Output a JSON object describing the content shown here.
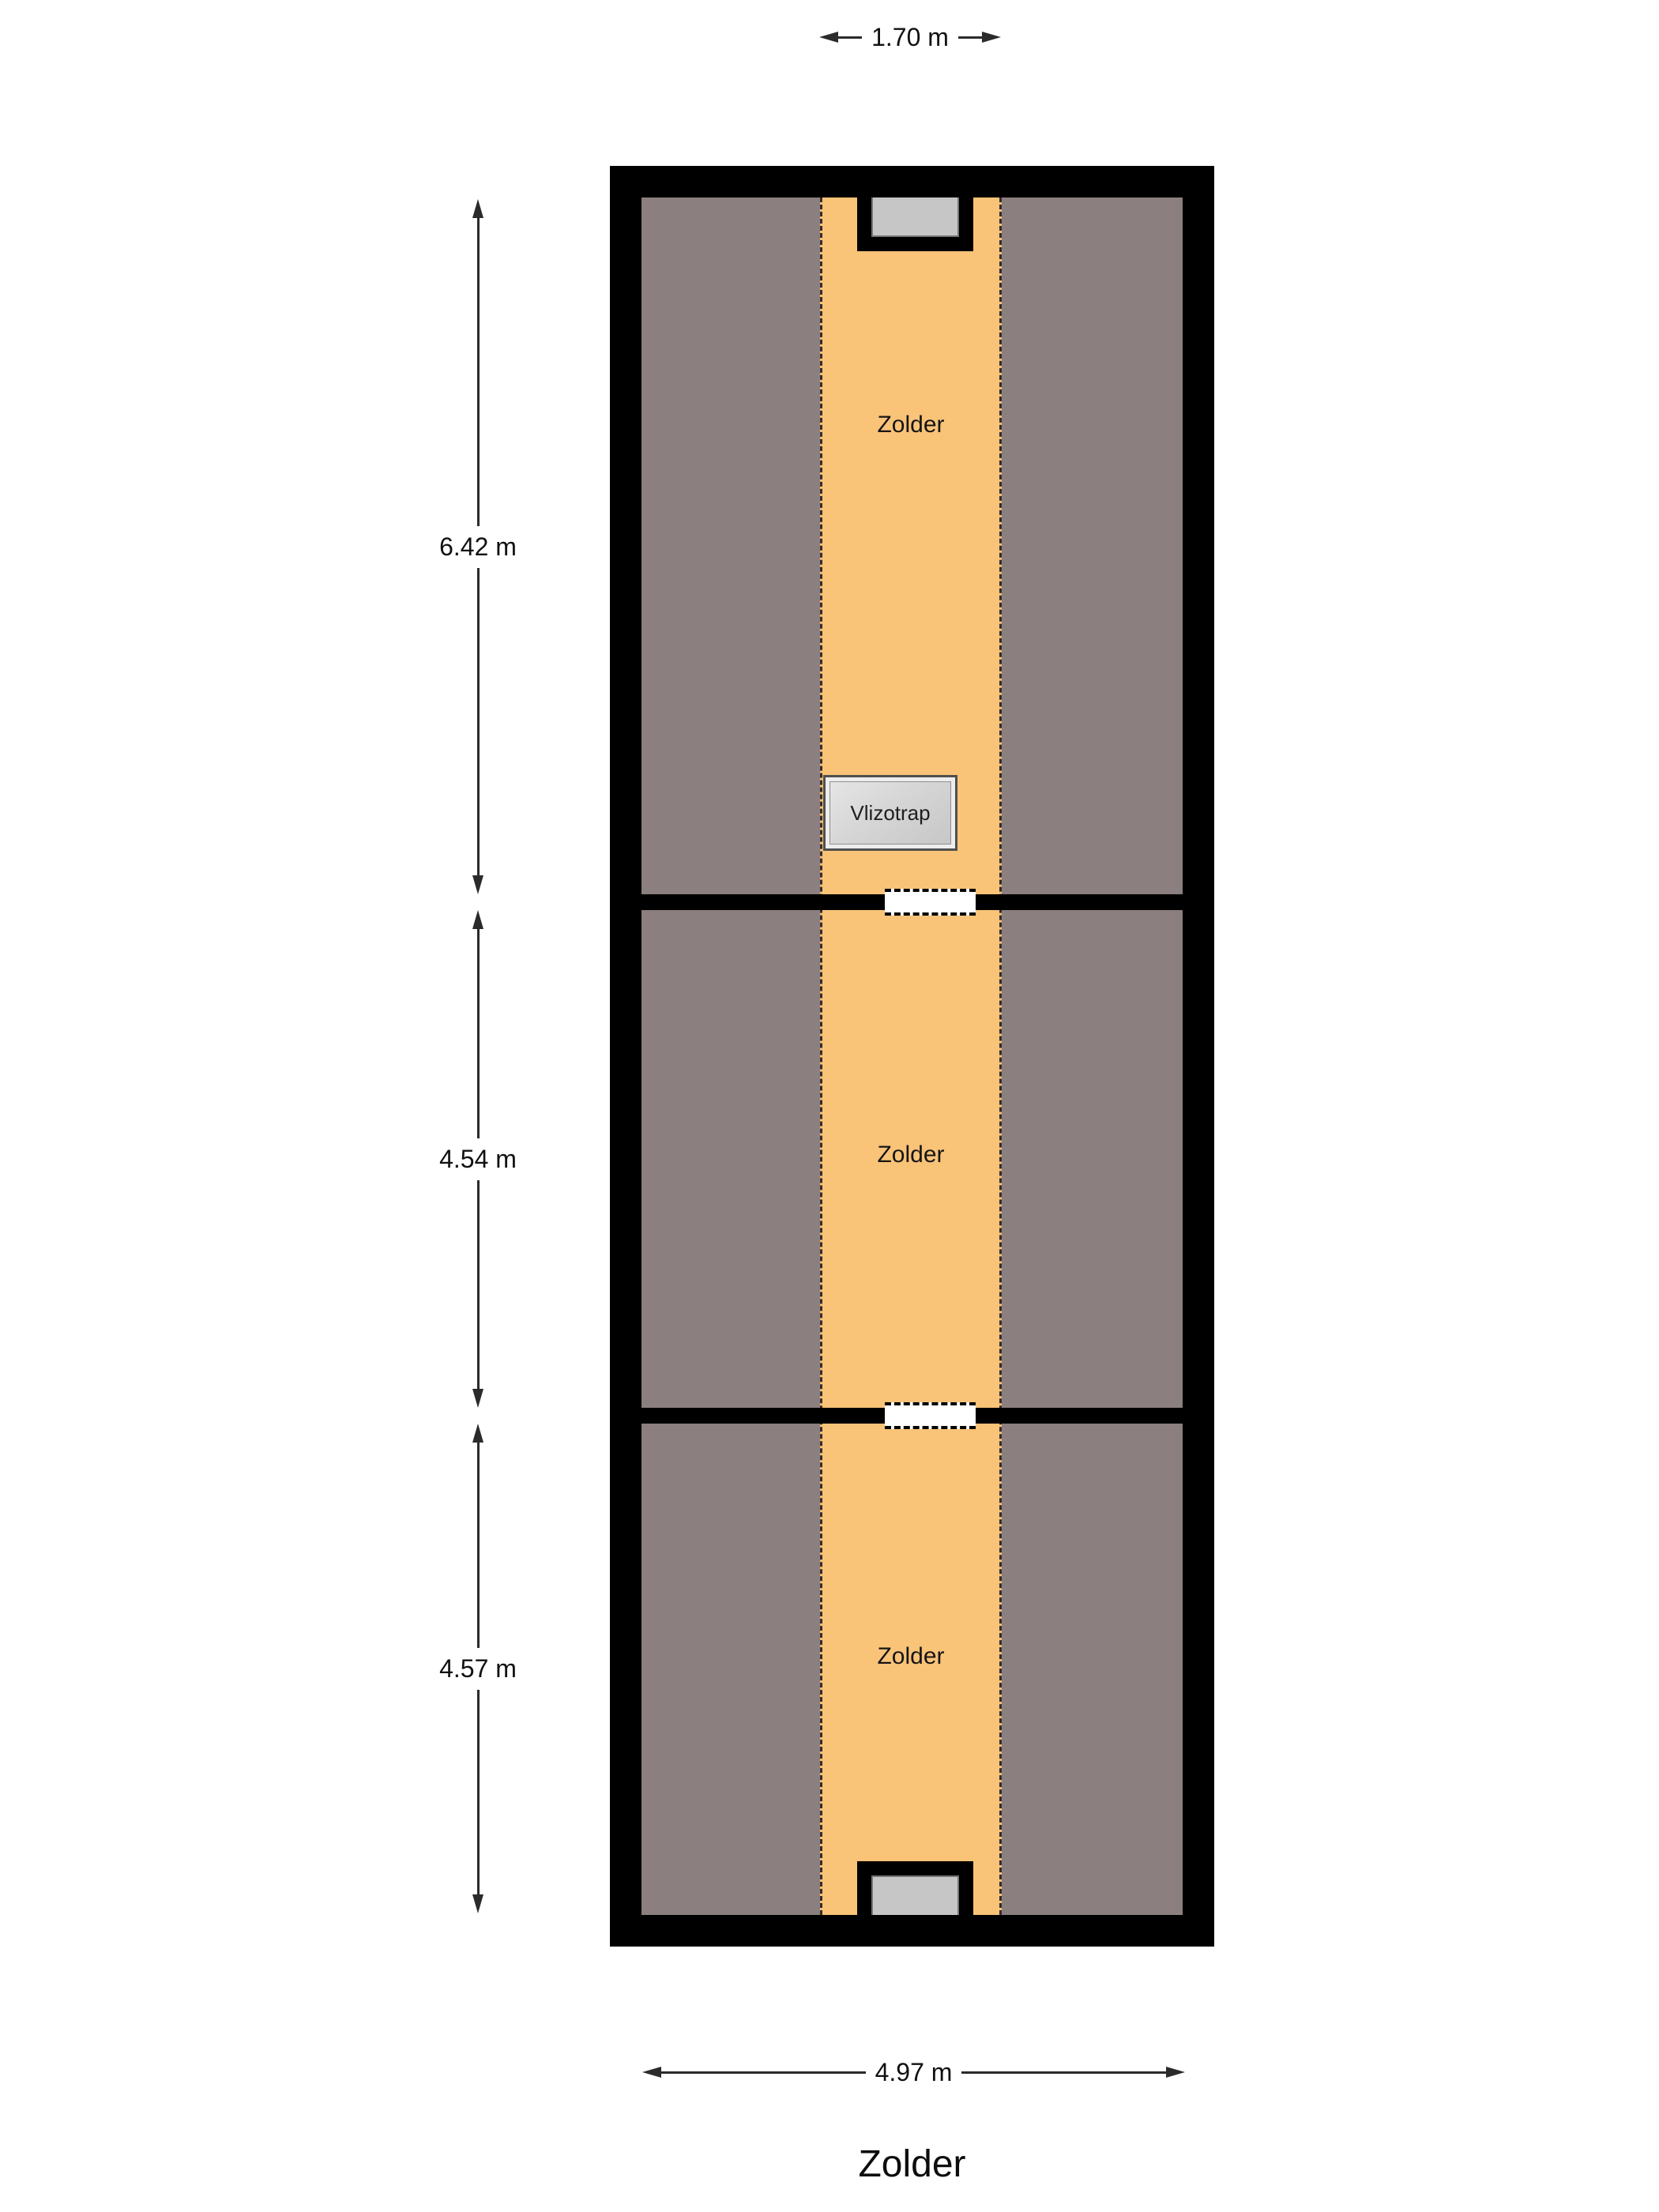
{
  "plan": {
    "floor_title": "Zolder",
    "rooms": [
      {
        "label": "Zolder"
      },
      {
        "label": "Zolder"
      },
      {
        "label": "Zolder"
      }
    ],
    "stair": {
      "label": "Vlizotrap"
    },
    "dimensions": {
      "top_width": "1.70 m",
      "bottom_width": "4.97 m",
      "left_heights": [
        "6.42 m",
        "4.54 m",
        "4.57 m"
      ]
    },
    "colors": {
      "wall": "#000000",
      "roof-area": "#8c7f7f",
      "floor-area": "#f9c378",
      "window-pane": "#c6c6c6",
      "dim-line": "#2b2b2b",
      "text": "#1c1c1c"
    }
  }
}
